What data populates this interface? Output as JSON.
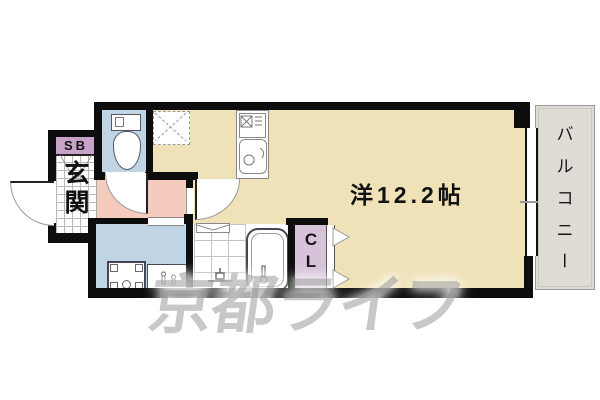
{
  "plan": {
    "rooms": {
      "main": {
        "label": "洋12.2帖"
      },
      "balcony": {
        "label": "バルコニー",
        "chars": [
          "バ",
          "ル",
          "コ",
          "ニ",
          "ー"
        ]
      },
      "entrance": {
        "label": "玄関",
        "chars": [
          "玄",
          "関"
        ]
      },
      "shoebox": {
        "label": "SB"
      },
      "closet": {
        "label": "CL",
        "chars": [
          "C",
          "L"
        ]
      }
    },
    "watermark": {
      "text": "京都ライフ"
    },
    "colors": {
      "room_floor": "#F0E2B8",
      "wet_area": "#BFD5E5",
      "hallway": "#F5CBBE",
      "closet": "#D6C3DA",
      "shoebox": "#C7A3C9",
      "balcony": "#DFDCD6",
      "wall": "#0D0D0D",
      "watermark_gray": "rgba(125,125,125,0.42)"
    }
  }
}
